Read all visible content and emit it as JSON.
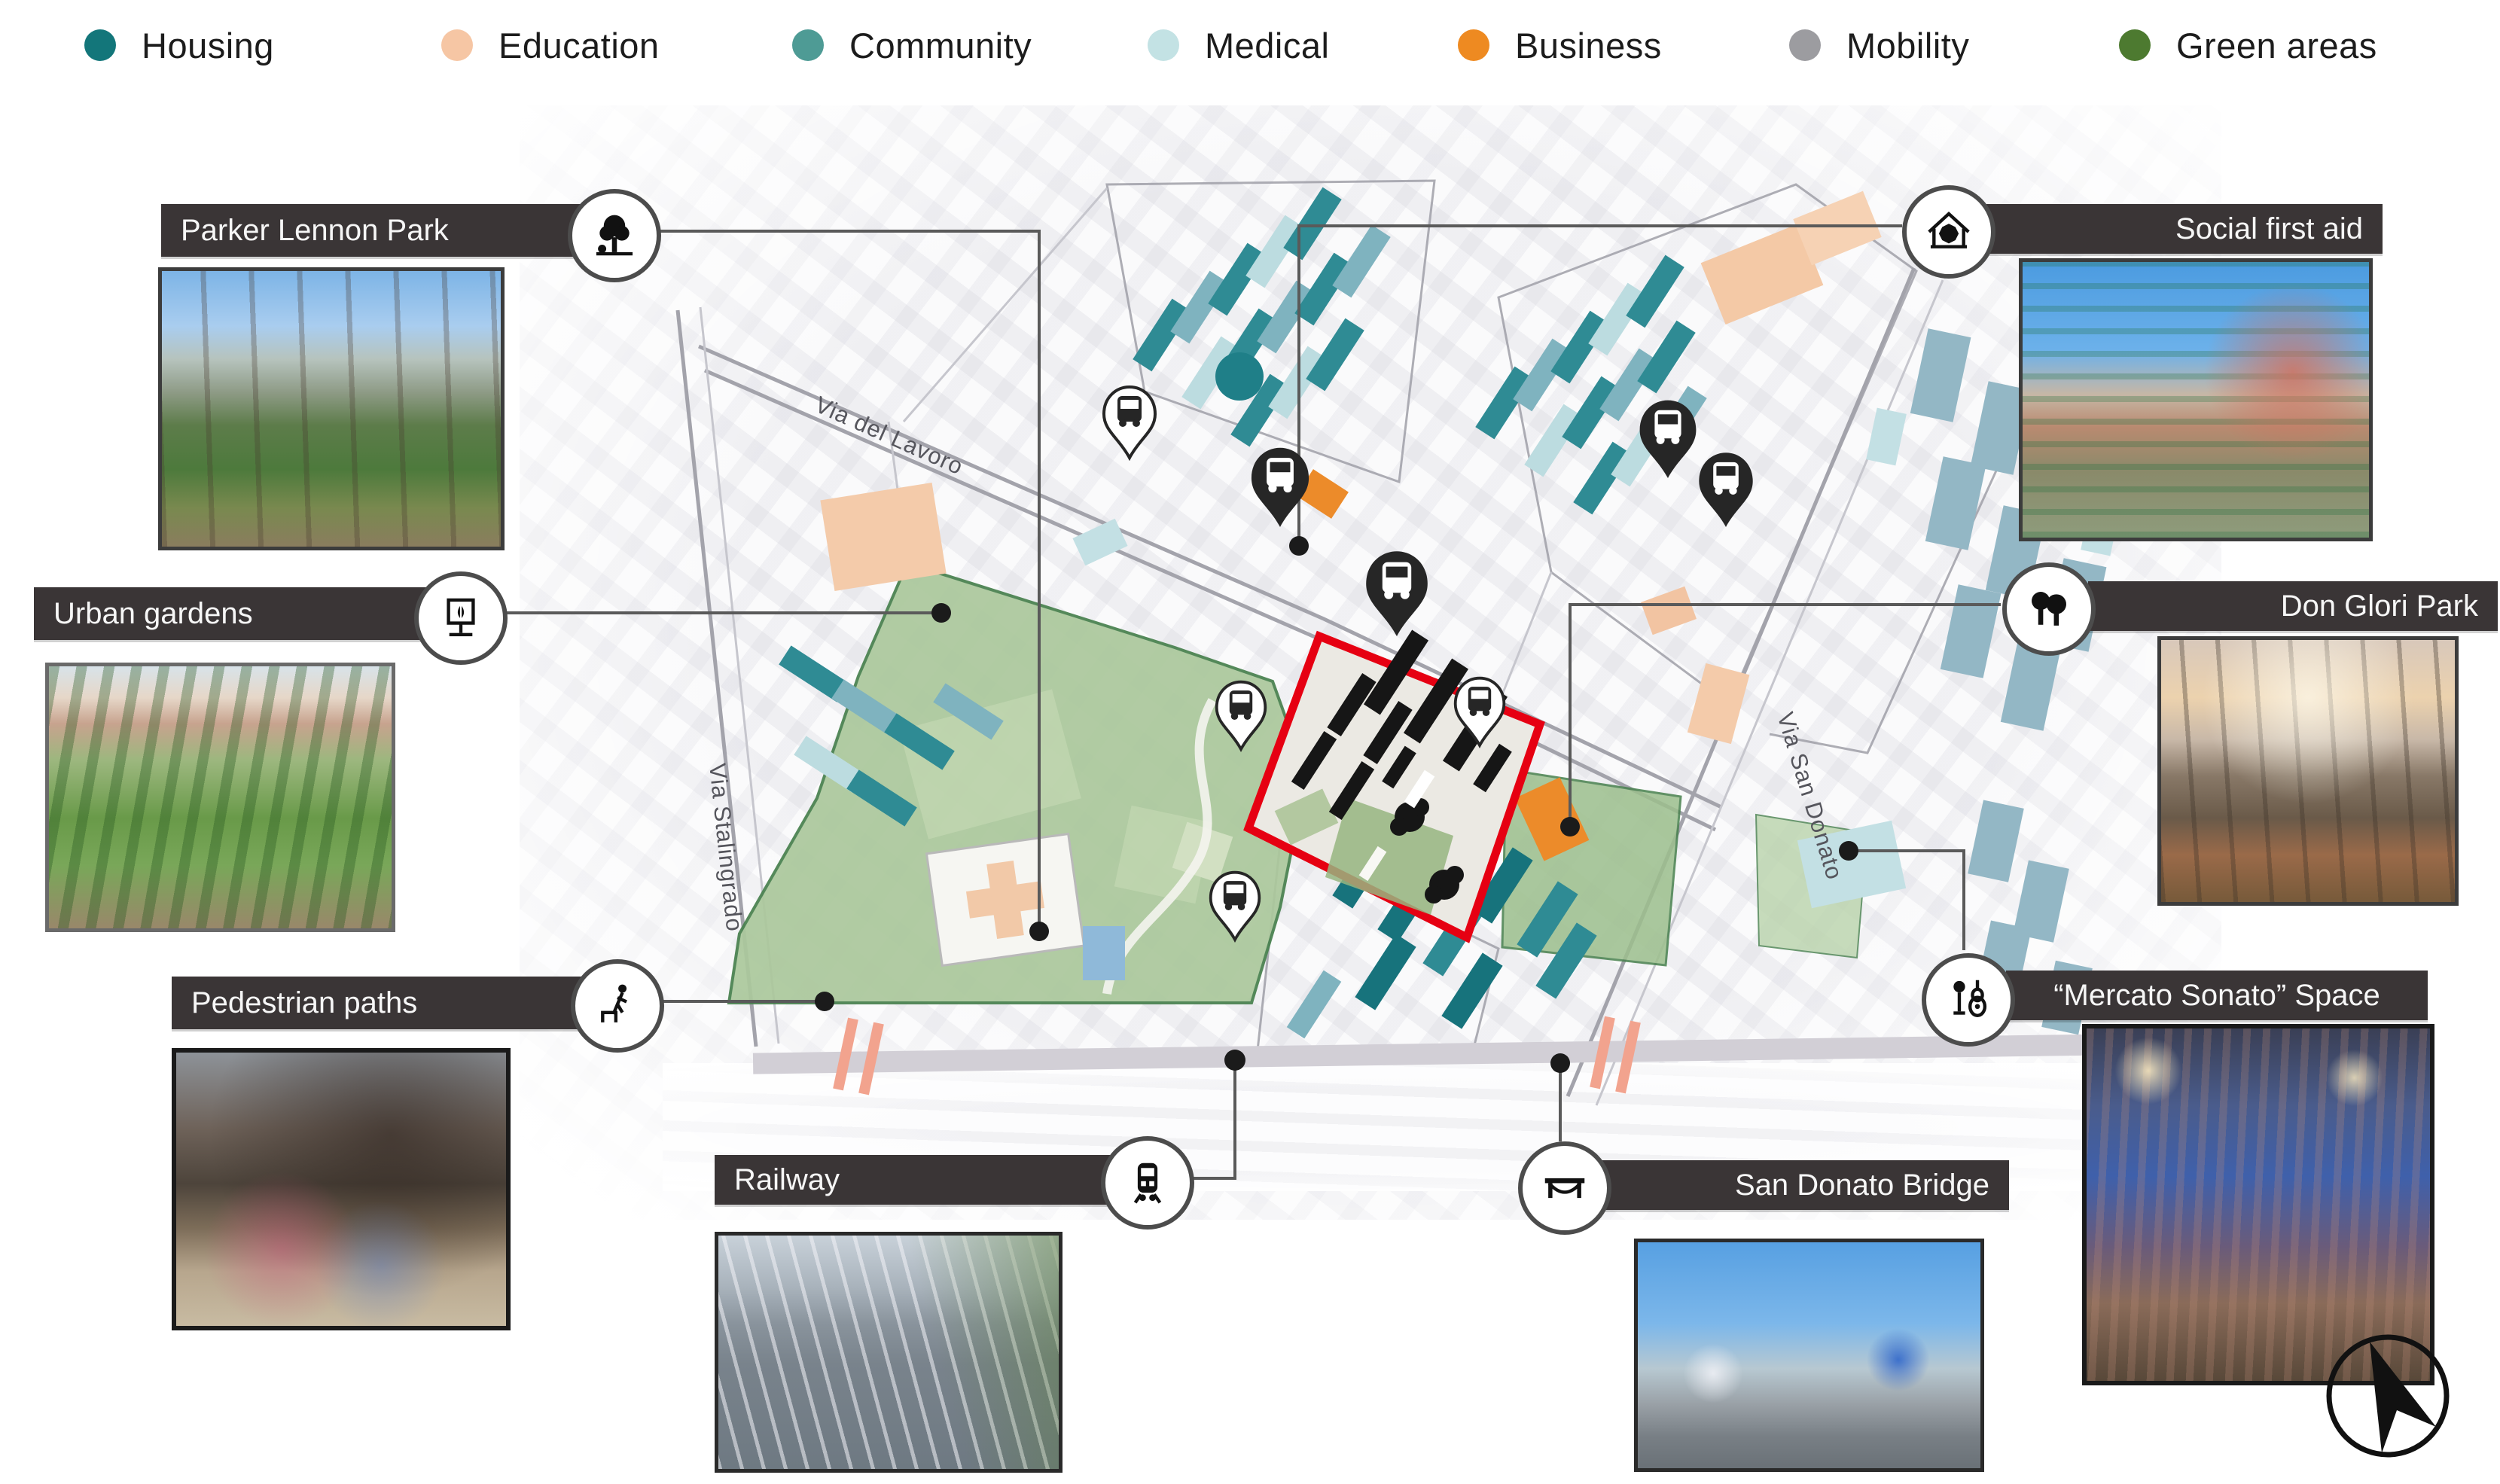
{
  "legend": {
    "items": [
      {
        "label": "Housing",
        "color": "#13767a"
      },
      {
        "label": "Education",
        "color": "#f6c6a4"
      },
      {
        "label": "Community",
        "color": "#4e9b95"
      },
      {
        "label": "Medical",
        "color": "#c3e2e4"
      },
      {
        "label": "Business",
        "color": "#ee8a21"
      },
      {
        "label": "Mobility",
        "color": "#9c9ca0"
      },
      {
        "label": "Green areas",
        "color": "#4d7a30"
      }
    ]
  },
  "callouts": [
    {
      "id": "parker-lennon-park",
      "label": "Parker Lennon Park",
      "icon": "tree-icon"
    },
    {
      "id": "urban-gardens",
      "label": "Urban gardens",
      "icon": "garden-planter-icon"
    },
    {
      "id": "pedestrian-paths",
      "label": "Pedestrian paths",
      "icon": "pedestrian-icon"
    },
    {
      "id": "railway",
      "label": "Railway",
      "icon": "train-icon"
    },
    {
      "id": "san-donato-bridge",
      "label": "San Donato Bridge",
      "icon": "bridge-icon"
    },
    {
      "id": "mercato-sonato",
      "label": "“Mercato Sonato” Space",
      "icon": "music-icon"
    },
    {
      "id": "don-glori-park",
      "label": "Don Glori Park",
      "icon": "twin-trees-icon"
    },
    {
      "id": "social-first-aid",
      "label": "Social first aid",
      "icon": "house-aid-icon"
    }
  ],
  "map": {
    "street_labels": {
      "via_del_lavoro": "Via del Lavoro",
      "via_stalingrado": "Via Stalingrado",
      "via_san_donato": "Via San Donato"
    },
    "site_outline_color": "#e60012",
    "railway_tick_color": "#f2a38e"
  }
}
